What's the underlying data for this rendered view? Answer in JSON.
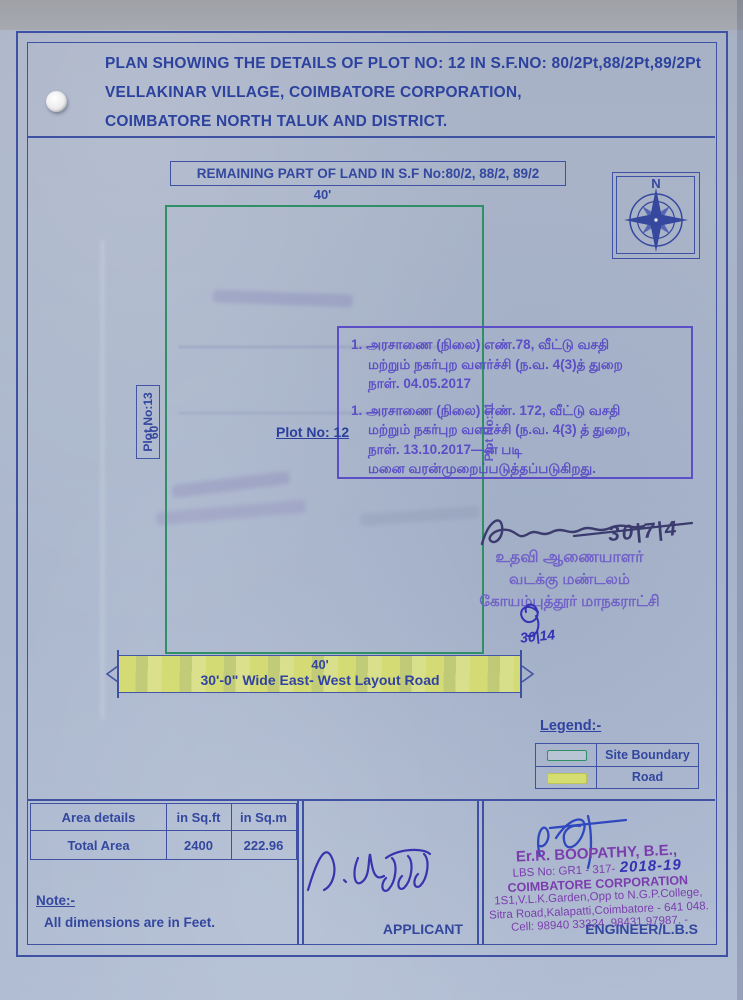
{
  "document": {
    "title_lines": [
      "PLAN SHOWING THE DETAILS OF PLOT NO: 12 IN S.F.NO: 80/2Pt,88/2Pt,89/2Pt",
      "VELLAKINAR VILLAGE, COIMBATORE CORPORATION,",
      "COIMBATORE NORTH TALUK AND DISTRICT."
    ]
  },
  "plan": {
    "remaining_land_label": "REMAINING PART OF LAND IN S.F No:80/2, 88/2, 89/2",
    "north_label": "N",
    "dim_top": "40'",
    "dim_left": "60'",
    "dim_road": "40'",
    "plot12_label": "Plot No: 12",
    "plot13_label": "Plot No:13",
    "plot11_label": "Plot No:11",
    "road_label": "30'-0\" Wide East- West Layout Road"
  },
  "approval_stamp": {
    "item1_lines": [
      "1. அரசாணை (நிலை) எண்.78, வீட்டு வசதி",
      "மற்றும் நகர்புற வளர்ச்சி (ந.வ. 4(3)த் துறை",
      "நாள். 04.05.2017"
    ],
    "item2_lines": [
      "1. அரசாணை (நிலை) எண். 172, வீட்டு வசதி",
      "மற்றும் நகர்புற வளர்ச்சி (ந.வ. 4(3) த் துறை,",
      "நாள். 13.10.2017—ன் படி",
      "மனை வரன்முறைப்படுத்தப்படுகிறது."
    ]
  },
  "officer": {
    "date_main": "30|7|4",
    "date_small": "30|14",
    "stamp_lines": [
      "உதவி ஆணையாளர்",
      "வடக்கு மண்டலம்",
      "கோயம்புத்தூர் மாநகராட்சி"
    ]
  },
  "legend": {
    "title": "Legend:-",
    "items": [
      {
        "label": "Site Boundary"
      },
      {
        "label": "Road"
      }
    ]
  },
  "area_table": {
    "headers": [
      "Area details",
      "in Sq.ft",
      "in Sq.m"
    ],
    "rows": [
      [
        "Total Area",
        "2400",
        "222.96"
      ]
    ]
  },
  "note": {
    "title": "Note:-",
    "text": "All dimensions are in Feet."
  },
  "signature_block": {
    "applicant_label": "APPLICANT",
    "engineer_label": "ENGINEER/L.B.S"
  },
  "engineer_stamp": {
    "name": "Er.R. BOOPATHY, B.E.,",
    "lbs_line": "LBS No: GR1 - 317-",
    "lbs_handwritten": "2018-19",
    "org": "COIMBATORE CORPORATION",
    "address1": "1S1,V.L.K.Garden,Opp to N.G.P.College,",
    "address2": "Sitra Road,Kalapatti,Coimbatore - 641 048.",
    "cell": "Cell: 98940 33324, 98431 97987. -"
  },
  "colors": {
    "paper": "#aab6cc",
    "border_blue": "#3f51a2",
    "text_blue": "#2c429e",
    "boundary_green": "#2f9068",
    "road_yellow": "#d6dd70",
    "stamp_purple": "#5b4ec6",
    "officer_stamp_purple": "#7161c8",
    "engineer_stamp_purple": "#7b3dae",
    "ink_dark": "#3b3b6e",
    "ink_blue": "#3531b5"
  }
}
